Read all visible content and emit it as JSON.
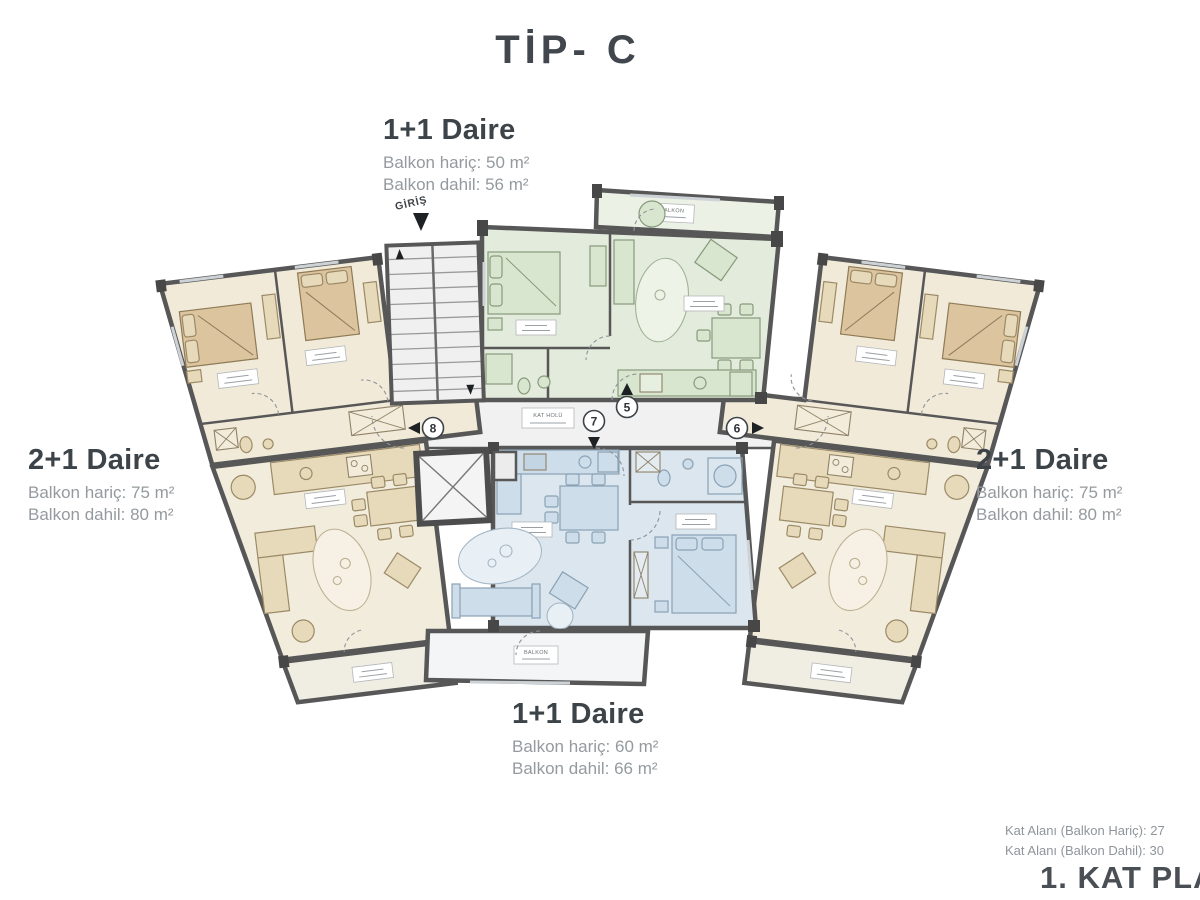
{
  "title": "TİP- C",
  "units": {
    "top": {
      "name": "1+1 Daire",
      "line1": "Balkon hariç: 50 m²",
      "line2": "Balkon dahil: 56 m²"
    },
    "left": {
      "name": "2+1 Daire",
      "line1": "Balkon hariç: 75 m²",
      "line2": "Balkon dahil: 80 m²"
    },
    "right": {
      "name": "2+1 Daire",
      "line1": "Balkon hariç: 75 m²",
      "line2": "Balkon dahil: 80 m²"
    },
    "bottom": {
      "name": "1+1 Daire",
      "line1": "Balkon hariç: 60 m²",
      "line2": "Balkon dahil: 66 m²"
    }
  },
  "plan": {
    "entrance_label": "GİRİŞ",
    "hall_label": "KAT HOLÜ",
    "balcony_label": "BALKON",
    "unit_numbers": {
      "n5": "5",
      "n6": "6",
      "n7": "7",
      "n8": "8"
    }
  },
  "footer": {
    "area_excl": "Kat Alanı (Balkon Hariç): 27",
    "area_incl": "Kat Alanı (Balkon Dahil): 30",
    "plan_name": "1. KAT PLA"
  },
  "colors": {
    "wall": "#575757",
    "beige_unit": "#f1ead9",
    "cream_unit": "#f2ecdd",
    "green_unit": "#e3ecdc",
    "blue_unit": "#dbe6ee",
    "corridor": "#f0f0f0",
    "heading_text": "#3d4449",
    "muted_text": "#949a9e"
  }
}
